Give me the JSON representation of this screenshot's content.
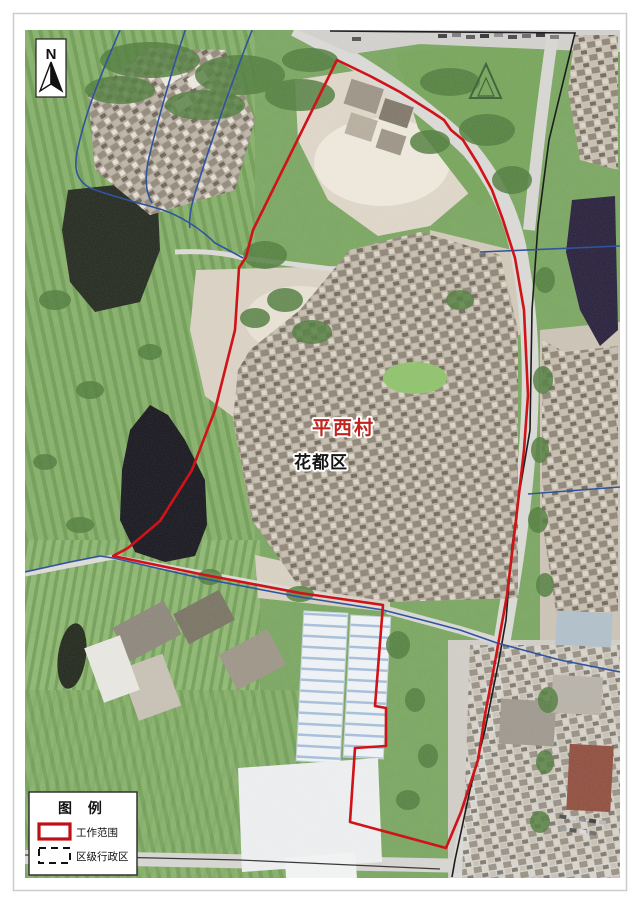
{
  "map": {
    "village_label": "平西村",
    "district_label": "花都区",
    "north_label": "N",
    "colors": {
      "boundary_red": "#cf1318",
      "admin_blue": "#2f54a0",
      "road_line_black": "#1d1d1d",
      "village_label_red": "#c0241c",
      "district_label_black": "#151515"
    }
  },
  "legend": {
    "title": "图  例",
    "items": [
      {
        "label": "工作范围",
        "swatch": "work-area-red-rect"
      },
      {
        "label": "区级行政区",
        "swatch": "district-dashed-rect"
      }
    ]
  }
}
